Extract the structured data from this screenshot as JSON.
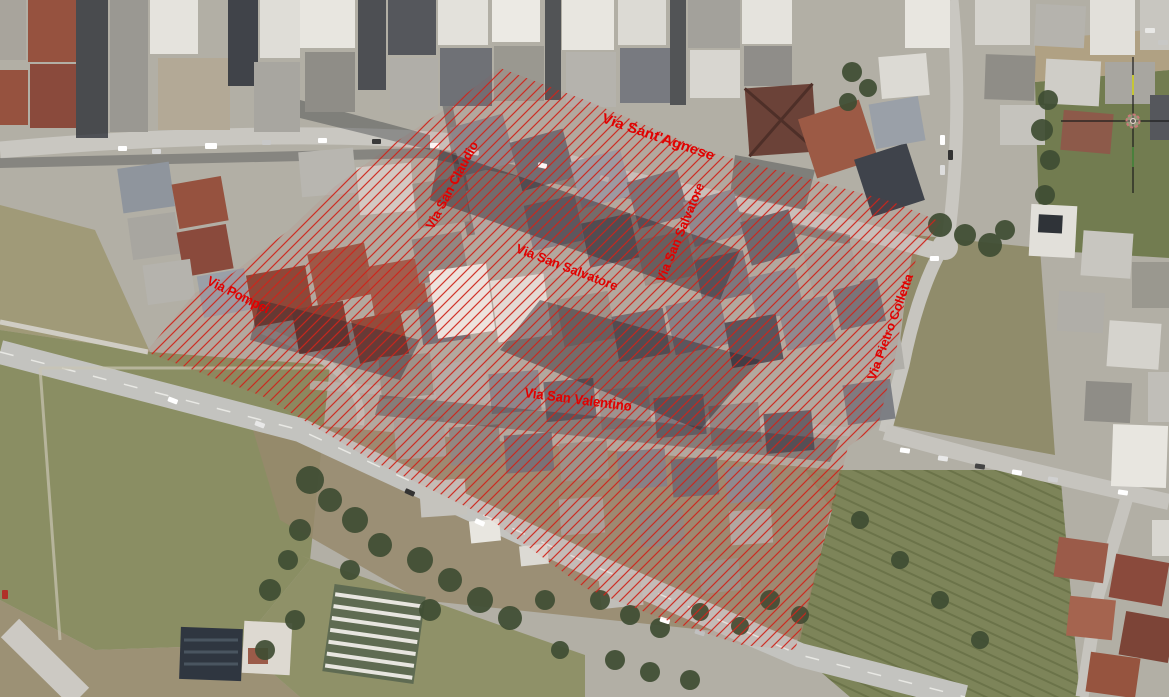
{
  "map": {
    "type": "aerial-photo-with-annotation",
    "description": "Satellite view of an urban block outlined with red diagonal hatching and red street name labels"
  },
  "street_labels": [
    {
      "name": "via-sant-agnese",
      "text": "Via Sant'Agnese"
    },
    {
      "name": "via-san-claudio",
      "text": "Via San Claudio"
    },
    {
      "name": "via-san-salvatore-upper",
      "text": "Via San Salvatore"
    },
    {
      "name": "via-san-salvatore-lower",
      "text": "Via San Salvatore"
    },
    {
      "name": "via-pompei",
      "text": "Via Pompei"
    },
    {
      "name": "via-san-valentino",
      "text": "Via San Valentino"
    },
    {
      "name": "via-pietro-colletta",
      "text": "Via Pietro Colletta"
    }
  ],
  "overlay": {
    "points": "500,68 585,100 712,153 795,175 893,202 941,222 918,252 905,300 895,358 878,425 848,447 832,510 806,613 795,650 742,645 660,618 585,588 487,517 375,462 262,396 146,352 195,293 233,273 289,230 334,187 399,140 450,106",
    "hatch_color": "#cf241a",
    "label_color": "#e10000"
  },
  "cursor": {
    "transform": "translate(1133,121)",
    "x": 1133,
    "y": 121
  }
}
